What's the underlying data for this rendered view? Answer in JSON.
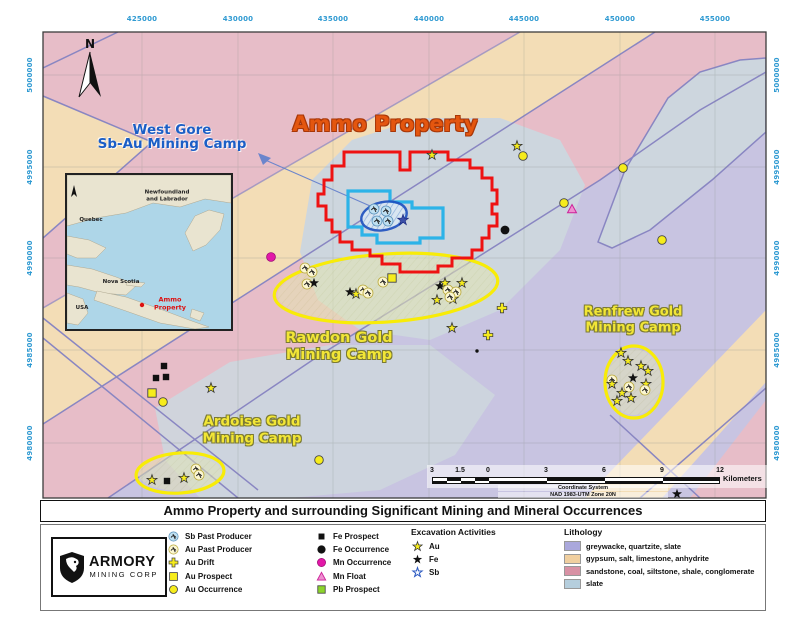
{
  "title_bar": "Ammo Property and surrounding Significant Mining and Mineral Occurrences",
  "colors": {
    "property_red": "#ee1212",
    "claim_cyan": "#2cb3e8",
    "deposit_navy": "#1d50c0",
    "camp_yellow": "#f8ec07",
    "coord_blue": "#2f9ad2"
  },
  "map": {
    "coords_top": [
      "425000",
      "430000",
      "435000",
      "440000",
      "445000",
      "450000",
      "455000"
    ],
    "coords_left": [
      "5000000",
      "4995000",
      "4990000",
      "4985000",
      "4980000"
    ],
    "coords_right": [
      "5000000",
      "4995000",
      "4990000",
      "4985000",
      "4980000"
    ],
    "labels": {
      "north": "N",
      "ammo_property": "Ammo Property",
      "west_gore_line1": "West Gore",
      "west_gore_line2": "Sb-Au Mining Camp",
      "rawdon_line1": "Rawdon Gold",
      "rawdon_line2": "Mining Camp",
      "renfrew_line1": "Renfrew Gold",
      "renfrew_line2": "Mining Camp",
      "ardoise_line1": "Ardoise Gold",
      "ardoise_line2": "Mining Camp"
    },
    "scale": {
      "labels": [
        "3",
        "1.5",
        "0",
        "3",
        "6",
        "9",
        "12"
      ],
      "unit": "Kilometers",
      "crs_line1": "Coordinate System",
      "crs_line2": "NAD 1983-UTM Zone 20N"
    },
    "markers": [
      {
        "t": "star_au",
        "x": 432,
        "y": 155
      },
      {
        "t": "star_au",
        "x": 517,
        "y": 146
      },
      {
        "t": "au_occ",
        "x": 523,
        "y": 156
      },
      {
        "t": "au_occ",
        "x": 623,
        "y": 168
      },
      {
        "t": "au_occ",
        "x": 564,
        "y": 203
      },
      {
        "t": "mn_float",
        "x": 572,
        "y": 209
      },
      {
        "t": "fe_occ",
        "x": 505,
        "y": 230
      },
      {
        "t": "au_occ",
        "x": 662,
        "y": 240
      },
      {
        "t": "mn_occ",
        "x": 271,
        "y": 257
      },
      {
        "t": "sb_pp",
        "x": 374,
        "y": 209
      },
      {
        "t": "sb_pp",
        "x": 386,
        "y": 211
      },
      {
        "t": "sb_pp",
        "x": 377,
        "y": 221
      },
      {
        "t": "sb_pp",
        "x": 388,
        "y": 221
      },
      {
        "t": "star_sb",
        "x": 403,
        "y": 220
      },
      {
        "t": "au_pp",
        "x": 305,
        "y": 268
      },
      {
        "t": "au_pp",
        "x": 312,
        "y": 272
      },
      {
        "t": "au_pp",
        "x": 307,
        "y": 284
      },
      {
        "t": "star_fe",
        "x": 314,
        "y": 283
      },
      {
        "t": "star_fe",
        "x": 350,
        "y": 292
      },
      {
        "t": "star_au",
        "x": 356,
        "y": 294
      },
      {
        "t": "au_pp",
        "x": 363,
        "y": 290
      },
      {
        "t": "au_pp",
        "x": 368,
        "y": 293
      },
      {
        "t": "au_pp",
        "x": 383,
        "y": 282
      },
      {
        "t": "au_pros",
        "x": 392,
        "y": 278
      },
      {
        "t": "star_fe",
        "x": 440,
        "y": 286
      },
      {
        "t": "star_au",
        "x": 445,
        "y": 283
      },
      {
        "t": "star_au",
        "x": 462,
        "y": 283
      },
      {
        "t": "star_au",
        "x": 437,
        "y": 300
      },
      {
        "t": "star_au",
        "x": 453,
        "y": 299
      },
      {
        "t": "au_pp",
        "x": 448,
        "y": 290
      },
      {
        "t": "au_pp",
        "x": 456,
        "y": 292
      },
      {
        "t": "au_pp",
        "x": 450,
        "y": 297
      },
      {
        "t": "star_au",
        "x": 452,
        "y": 328
      },
      {
        "t": "au_drift",
        "x": 502,
        "y": 308
      },
      {
        "t": "au_drift",
        "x": 488,
        "y": 335
      },
      {
        "t": "dot",
        "x": 477,
        "y": 351
      },
      {
        "t": "fe_pros",
        "x": 164,
        "y": 366
      },
      {
        "t": "fe_pros",
        "x": 156,
        "y": 378
      },
      {
        "t": "fe_pros",
        "x": 166,
        "y": 377
      },
      {
        "t": "au_pros",
        "x": 152,
        "y": 393
      },
      {
        "t": "au_occ",
        "x": 163,
        "y": 402
      },
      {
        "t": "star_au",
        "x": 211,
        "y": 388
      },
      {
        "t": "au_occ",
        "x": 319,
        "y": 460
      },
      {
        "t": "star_au",
        "x": 152,
        "y": 480
      },
      {
        "t": "fe_pros",
        "x": 167,
        "y": 481
      },
      {
        "t": "star_au",
        "x": 184,
        "y": 478
      },
      {
        "t": "au_pp",
        "x": 196,
        "y": 469
      },
      {
        "t": "au_pp",
        "x": 199,
        "y": 475
      },
      {
        "t": "star_au",
        "x": 621,
        "y": 353
      },
      {
        "t": "star_au",
        "x": 628,
        "y": 361
      },
      {
        "t": "star_au",
        "x": 641,
        "y": 366
      },
      {
        "t": "star_au",
        "x": 648,
        "y": 371
      },
      {
        "t": "star_fe",
        "x": 633,
        "y": 378
      },
      {
        "t": "au_pp",
        "x": 612,
        "y": 380
      },
      {
        "t": "star_au",
        "x": 612,
        "y": 384
      },
      {
        "t": "au_pp",
        "x": 629,
        "y": 387
      },
      {
        "t": "star_au",
        "x": 646,
        "y": 384
      },
      {
        "t": "au_pp",
        "x": 645,
        "y": 390
      },
      {
        "t": "star_au",
        "x": 622,
        "y": 393
      },
      {
        "t": "star_au",
        "x": 631,
        "y": 398
      },
      {
        "t": "star_au",
        "x": 617,
        "y": 401
      },
      {
        "t": "star_fe",
        "x": 677,
        "y": 494
      }
    ]
  },
  "inset": {
    "labels": {
      "nl1": "Newfoundland",
      "nl2": "and Labrador",
      "quebec": "Quebec",
      "ns": "Nova Scotia",
      "usa": "USA",
      "ammo1": "Ammo",
      "ammo2": "Property"
    }
  },
  "legend": {
    "logo": {
      "name": "ARMORY",
      "sub": "MINING CORP"
    },
    "col1": [
      {
        "icon": "sb_pp",
        "label": "Sb Past Producer"
      },
      {
        "icon": "au_pp",
        "label": "Au Past Producer"
      },
      {
        "icon": "au_drift",
        "label": "Au Drift"
      },
      {
        "icon": "au_pros",
        "label": "Au Prospect"
      },
      {
        "icon": "au_occ",
        "label": "Au Occurrence"
      }
    ],
    "col2": [
      {
        "icon": "fe_pros",
        "label": "Fe Prospect"
      },
      {
        "icon": "fe_occ",
        "label": "Fe Occurrence"
      },
      {
        "icon": "mn_occ",
        "label": "Mn Occurrence"
      },
      {
        "icon": "mn_float",
        "label": "Mn Float"
      },
      {
        "icon": "pb_pros",
        "label": "Pb Prospect"
      }
    ],
    "excavation": {
      "header": "Excavation Activities",
      "items": [
        {
          "icon": "star_au",
          "label": "Au"
        },
        {
          "icon": "star_fe",
          "label": "Fe"
        },
        {
          "icon": "star_sb_o",
          "label": "Sb"
        }
      ]
    },
    "lithology": {
      "header": "Lithology",
      "items": [
        {
          "color": "#aaa8dc",
          "label": "greywacke, quartzite, slate"
        },
        {
          "color": "#f0cf9f",
          "label": "gypsum, salt, limestone, anhydrite"
        },
        {
          "color": "#d891a4",
          "label": "sandstone, coal, siltstone, shale, conglomerate"
        },
        {
          "color": "#b5cedd",
          "label": "slate"
        }
      ]
    }
  }
}
